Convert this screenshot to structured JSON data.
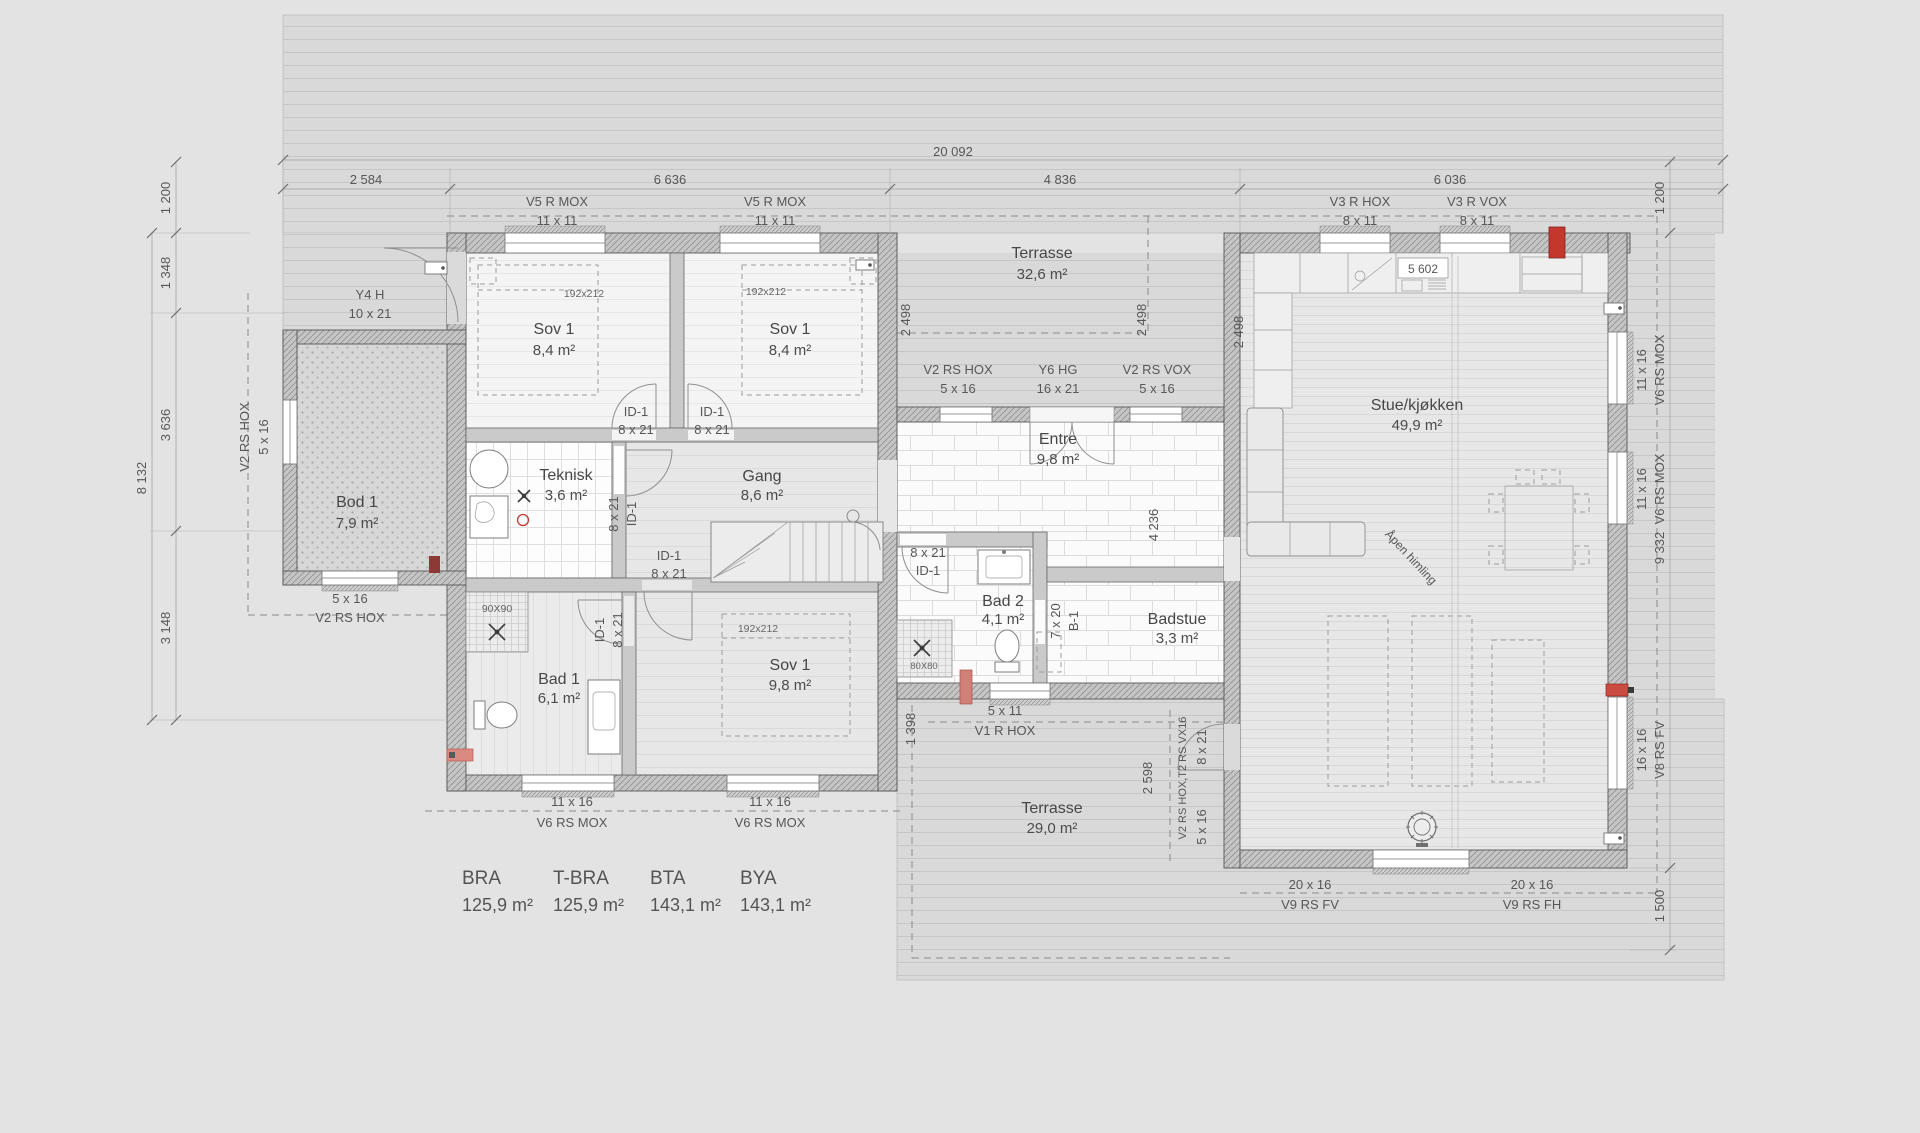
{
  "dims": {
    "total": "20 092",
    "seg1": "2 584",
    "seg2": "6 636",
    "seg3": "4 836",
    "seg4": "6 036",
    "left1": "1 200",
    "left2": "1 348",
    "left3": "3 636",
    "left_total": "8 132",
    "left4": "3 148",
    "right1": "1 200",
    "right2": "9 332",
    "right3": "1 500",
    "d2498": "2 498",
    "d4236": "4 236",
    "d1398": "1 398",
    "d2598": "2 598",
    "d5602": "5 602"
  },
  "rooms": {
    "sov1a": {
      "name": "Sov 1",
      "area": "8,4 m²"
    },
    "sov1b": {
      "name": "Sov 1",
      "area": "8,4 m²"
    },
    "terrasse1": {
      "name": "Terrasse",
      "area": "32,6 m²"
    },
    "bod": {
      "name": "Bod 1",
      "area": "7,9 m²"
    },
    "teknisk": {
      "name": "Teknisk",
      "area": "3,6 m²"
    },
    "gang": {
      "name": "Gang",
      "area": "8,6 m²"
    },
    "entre": {
      "name": "Entre",
      "area": "9,8 m²"
    },
    "bad2": {
      "name": "Bad 2",
      "area": "4,1 m²"
    },
    "badstue": {
      "name": "Badstue",
      "area": "3,3 m²"
    },
    "bad1": {
      "name": "Bad 1",
      "area": "6,1 m²"
    },
    "sov1c": {
      "name": "Sov 1",
      "area": "9,8 m²"
    },
    "stue": {
      "name": "Stue/kjøkken",
      "area": "49,9 m²"
    },
    "terrasse2": {
      "name": "Terrasse",
      "area": "29,0 m²"
    }
  },
  "openings": {
    "v5": {
      "code": "V5 R MOX",
      "size": "11 x 11"
    },
    "v3h": {
      "code": "V3 R HOX",
      "size": "8 x 11"
    },
    "v3v": {
      "code": "V3 R VOX",
      "size": "8 x 11"
    },
    "y4": {
      "code": "Y4 H",
      "size": "10 x 21"
    },
    "v2hox": {
      "code": "V2 RS HOX",
      "size": "5 x 16"
    },
    "y6": {
      "code": "Y6 HG",
      "size": "16 x 21"
    },
    "v2vox": {
      "code": "V2 RS VOX",
      "size": "5 x 16"
    },
    "id1": {
      "code": "ID-1",
      "size": "8 x 21"
    },
    "b1": {
      "code": "B-1",
      "size": "7 x 20"
    },
    "v1": {
      "code": "V1 R HOX",
      "size": "5 x 11"
    },
    "t2combo": {
      "code": "V2 RS HOX,T2 RS VX16",
      "size8": "8 x 21",
      "size5": "5 x 16"
    },
    "v6": {
      "code": "V6 RS MOX",
      "size": "11 x 16"
    },
    "v8": {
      "code": "V8 RS FV",
      "size": "16 x 16"
    },
    "v9fv": {
      "code": "V9 RS FV",
      "size": "20 x 16"
    },
    "v9fh": {
      "code": "V9 RS FH",
      "size": "20 x 16"
    }
  },
  "furniture": {
    "bed": "192x212",
    "shower_large": "90X90",
    "shower_small": "80X80"
  },
  "annotations": {
    "open_ceiling": "Åpen himling"
  },
  "area_table": {
    "items": [
      {
        "label": "BRA",
        "value": "125,9 m²"
      },
      {
        "label": "T-BRA",
        "value": "125,9 m²"
      },
      {
        "label": "BTA",
        "value": "143,1 m²"
      },
      {
        "label": "BYA",
        "value": "143,1 m²"
      }
    ]
  }
}
